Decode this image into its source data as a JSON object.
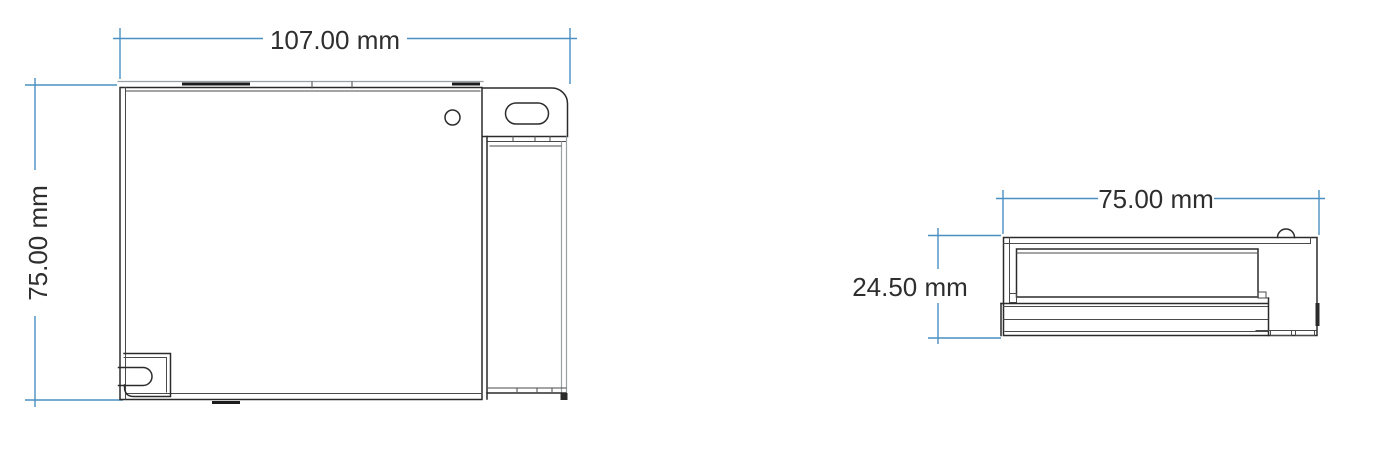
{
  "drawing": {
    "front_view": {
      "width_dimension": {
        "label": "107.00 mm"
      },
      "height_dimension": {
        "label": "75.00 mm"
      }
    },
    "side_view": {
      "width_dimension": {
        "label": "75.00 mm"
      },
      "height_dimension": {
        "label": "24.50 mm"
      }
    },
    "colors": {
      "dimension_line": "#4a90c2",
      "outline": "#2b2b2b",
      "outline_light": "#9aa0a4",
      "label_text": "#2e2e2e",
      "background": "#ffffff"
    }
  }
}
